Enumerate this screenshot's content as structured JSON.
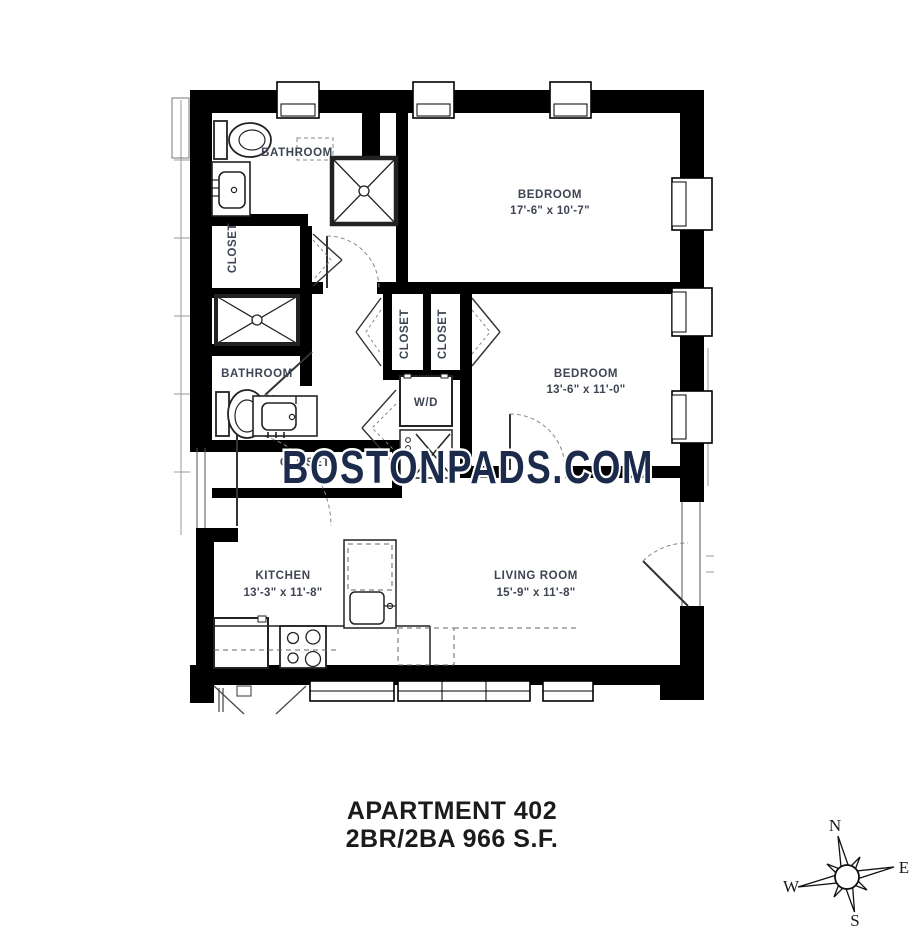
{
  "floorplan": {
    "watermark": "BOSTONPADS.COM",
    "title": {
      "line1": "APARTMENT 402",
      "line2": "2BR/2BA 966 S.F."
    },
    "rooms": {
      "bathroom1": {
        "name": "BATHROOM"
      },
      "closet_entry": {
        "name": "CLOSET"
      },
      "bedroom1": {
        "name": "BEDROOM",
        "dims": "17'-6\" x 10'-7\""
      },
      "closet_a": {
        "name": "CLOSET"
      },
      "closet_b": {
        "name": "CLOSET"
      },
      "bedroom2": {
        "name": "BEDROOM",
        "dims": "13'-6\" x 11'-0\""
      },
      "laundry": {
        "name": "W/D"
      },
      "bathroom2": {
        "name": "BATHROOM"
      },
      "closet_hall": {
        "name": "CLOSET"
      },
      "kitchen": {
        "name": "KITCHEN",
        "dims": "13'-3\" x 11'-8\""
      },
      "living": {
        "name": "LIVING ROOM",
        "dims": "15'-9\" x 11'-8\""
      }
    },
    "compass": {
      "north": "N",
      "east": "E",
      "south": "S",
      "west": "W"
    },
    "colors": {
      "wall": "#000000",
      "label": "#3d4453",
      "watermark": "#1c2a4b"
    }
  }
}
